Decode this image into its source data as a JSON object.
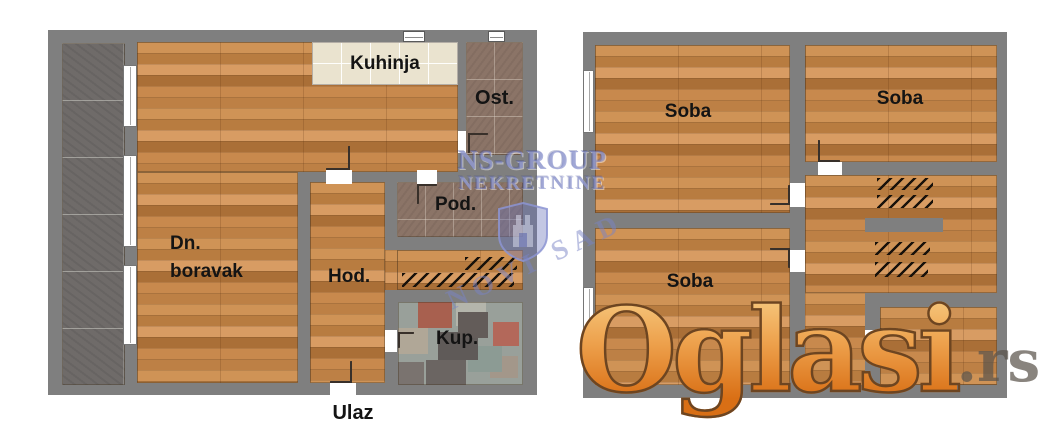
{
  "left_plan": {
    "kitchen": "Kuhinja",
    "pantry": "Ost.",
    "storage": "Pod.",
    "living_room_line1": "Dn.",
    "living_room_line2": "boravak",
    "hallway": "Hod.",
    "bathroom": "Kup.",
    "entrance": "Ulaz"
  },
  "right_plan": {
    "room_top_left": "Soba",
    "room_top_right": "Soba",
    "room_bottom": "Soba"
  },
  "watermarks": {
    "agency_line1": "NS-GROUP",
    "agency_line2": "NEKRETNINE",
    "agency_diagonal": "NOVI SAD",
    "portal_name": "Oglasi",
    "portal_suffix": ".rs"
  },
  "colors": {
    "wall_gray": "#7f7f7f",
    "wood_floor": "#c28349",
    "kitchen_tile": "#eae3cf",
    "pantry_tile": "#8b7467",
    "terrace_tile": "#6f6b69",
    "bath_tile": "#99a09a",
    "watermark_blue": "#7a84c6",
    "logo_orange": "#e8872f"
  }
}
